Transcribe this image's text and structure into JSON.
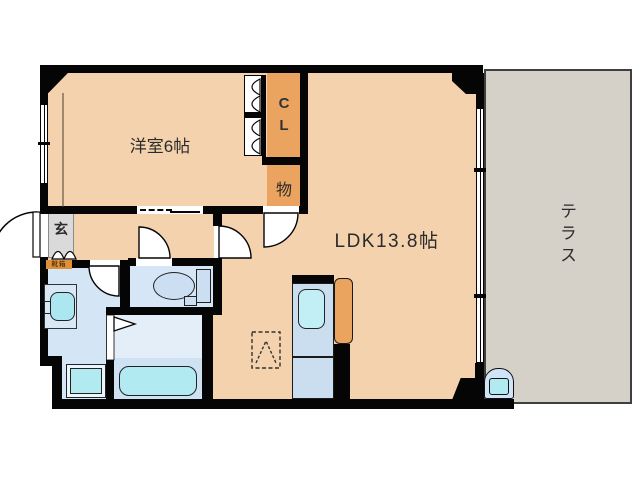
{
  "floorplan": {
    "unit_rooms": {
      "western_room": {
        "label": "洋室6帖"
      },
      "ldk": {
        "label": "LDK13.8帖"
      },
      "closet": {
        "label": "C\nL"
      },
      "storage": {
        "label": "物"
      },
      "entrance": {
        "label": "玄"
      },
      "shoe_cabinet": {
        "label": "靴箱"
      },
      "terrace": {
        "label": "テラス"
      }
    },
    "fixtures": [
      "toilet",
      "toilet-tank",
      "bathtub",
      "washbasin",
      "washing-machine-pan",
      "kitchen-sink",
      "kitchen-counter",
      "refrigerator-space",
      "outdoor-faucet",
      "entrance-door",
      "interior-doors",
      "bifold-closet-doors",
      "sliding-door",
      "windows"
    ],
    "colors": {
      "wall": "#050505",
      "room_fill": "#f4d2ae",
      "closet_fill": "#eba360",
      "terrace_fill": "#d5d1c8",
      "entrance_floor": "#dadada",
      "wet_area_fill": "#d4e5f5",
      "fixture_cyan": "#b2eaf2",
      "kitchen_counter_fill": "#cadef0",
      "shoe_cabinet_fill": "#dd8f3a",
      "background": "#ffffff"
    }
  }
}
